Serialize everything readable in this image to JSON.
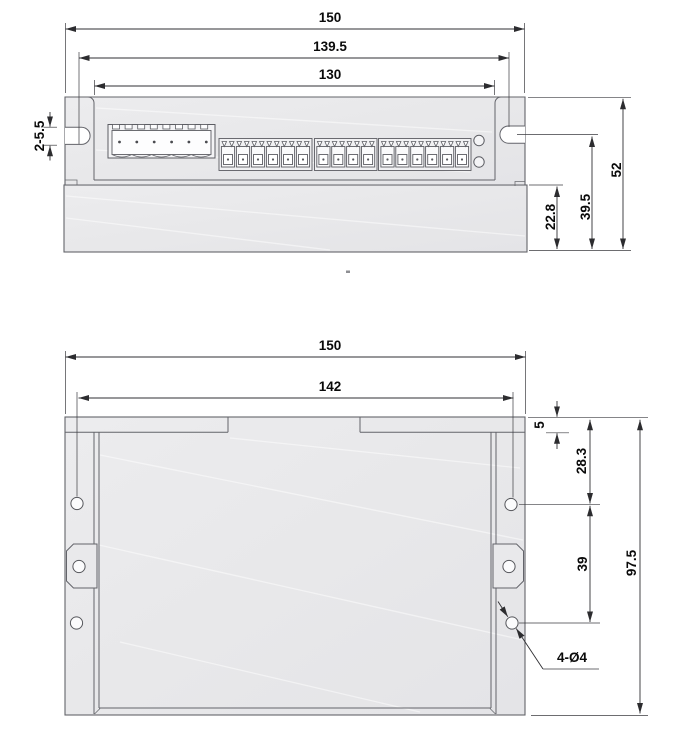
{
  "front_view": {
    "dims": {
      "overall_width": "150",
      "slot_center_width": "139.5",
      "panel_width": "130",
      "side_slot": "2-5.5",
      "base_height": "22.8",
      "slot_height": "39.5",
      "overall_height": "52"
    },
    "connector": {
      "pin_count": 6,
      "terminal_counts": [
        6,
        4,
        6
      ]
    },
    "led_count": 2
  },
  "plan_view": {
    "dims": {
      "overall_width": "150",
      "hole_span_width": "142",
      "flange_depth": "5",
      "hole_top_offset": "28.3",
      "hole_pitch": "39",
      "overall_depth": "97.5",
      "hole_callout": "4-Ø4"
    },
    "mounting_hole_count": 6
  },
  "colors": {
    "background": "#ffffff",
    "body_fill": "#e9e9eb",
    "outline": "#63646a",
    "dimension_line": "#2f2f33",
    "text": "#0a0a0a"
  }
}
